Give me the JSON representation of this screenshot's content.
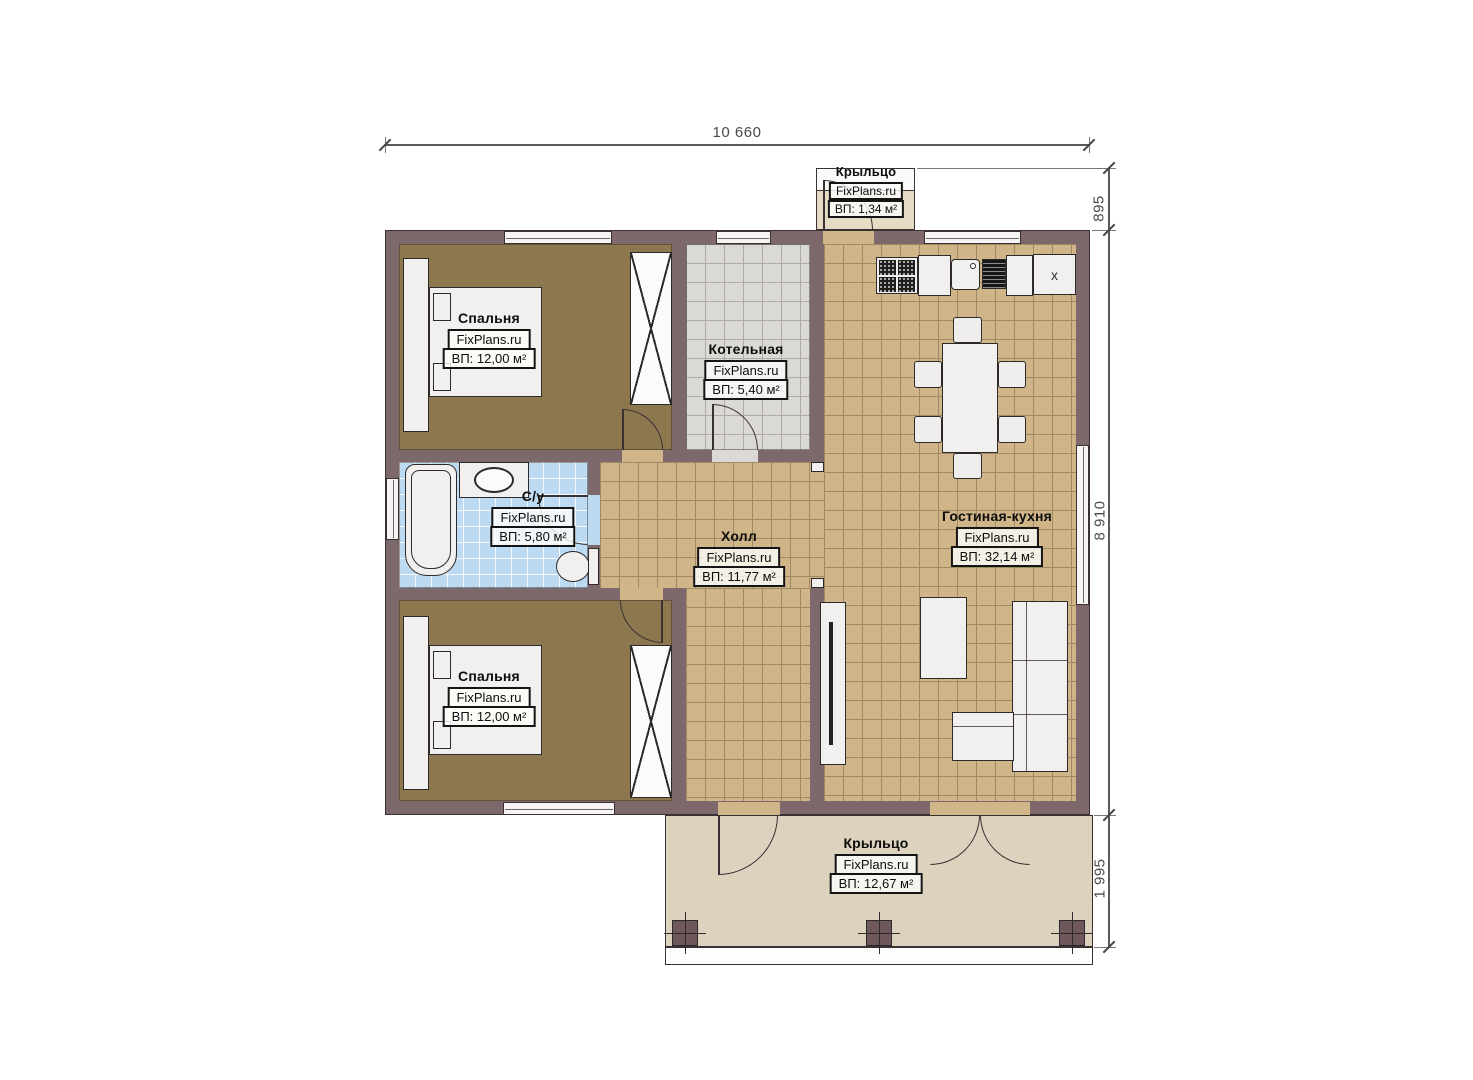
{
  "watermark": "FixPlans.ru",
  "dimensions": {
    "width_total": "10 660",
    "porch_top_depth": "895",
    "house_depth": "8 910",
    "porch_bottom_depth": "1 995"
  },
  "rooms": {
    "bedroom_top": {
      "name": "Спальня",
      "area": "ВП: 12,00 м²"
    },
    "boiler": {
      "name": "Котельная",
      "area": "ВП: 5,40 м²"
    },
    "bathroom": {
      "name": "С/у",
      "area": "ВП: 5,80 м²"
    },
    "hall": {
      "name": "Холл",
      "area": "ВП: 11,77 м²"
    },
    "living_kitchen": {
      "name": "Гостиная-кухня",
      "area": "ВП: 32,14 м²"
    },
    "bedroom_bottom": {
      "name": "Спальня",
      "area": "ВП: 12,00 м²"
    },
    "porch_top": {
      "name": "Крыльцо",
      "area": "ВП: 1,34 м²"
    },
    "porch_bottom": {
      "name": "Крыльцо",
      "area": "ВП: 12,67 м²"
    }
  },
  "markers": {
    "fridge": "x"
  },
  "colors": {
    "wall": "#7d686c",
    "floor_bedroom": "#8c774f",
    "floor_tile_tan": "#cfb587",
    "floor_tile_gray": "#dbd9d5",
    "floor_tile_blue": "#bddaf3",
    "porch_top": "#e6dcc6",
    "porch_bottom": "#dcd2bd",
    "furniture": "#f1f0ee",
    "line": "#3a3134"
  }
}
